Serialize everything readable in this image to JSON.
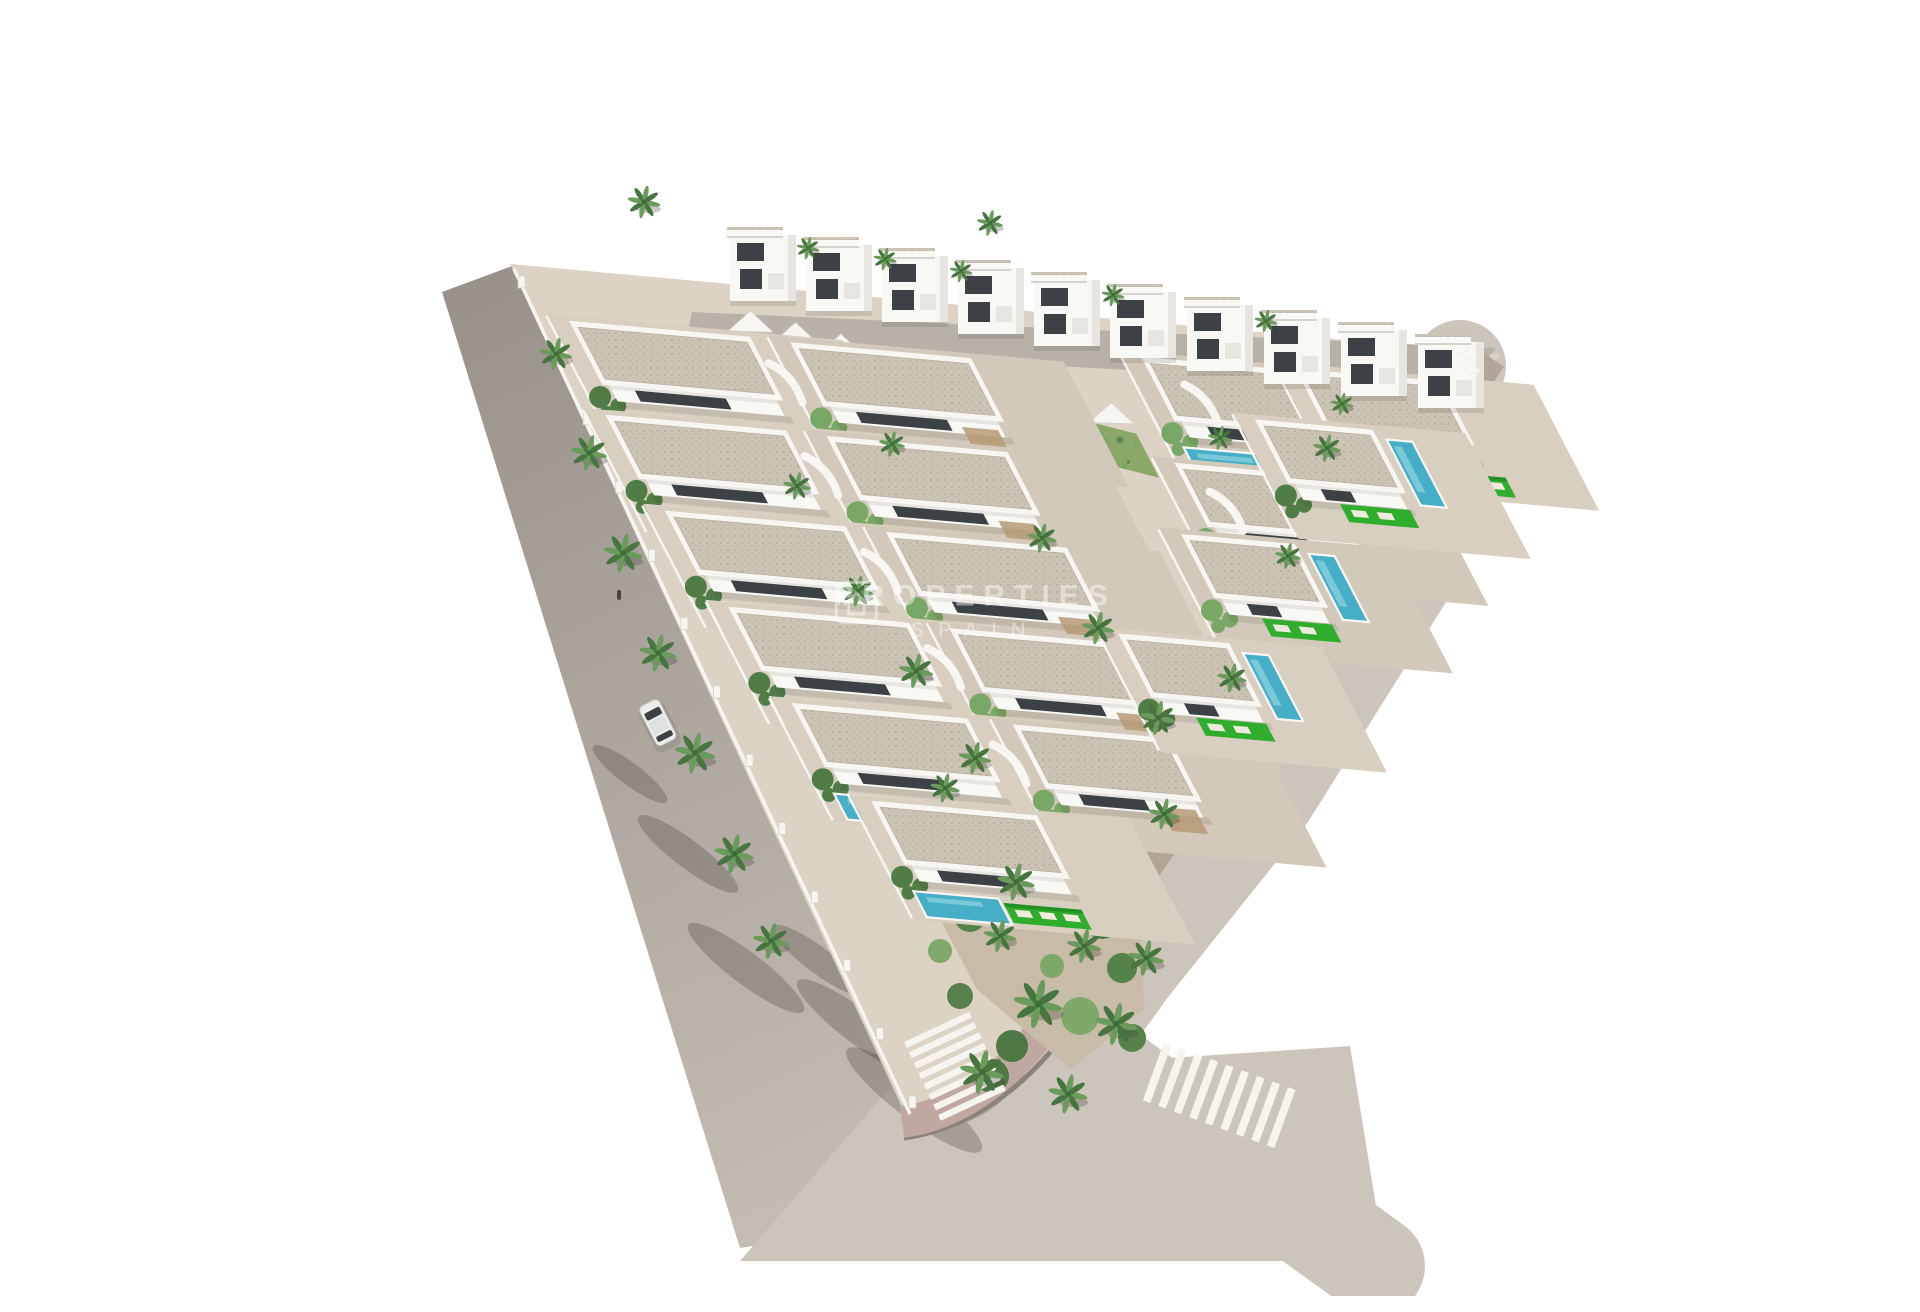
{
  "meta": {
    "type": "architectural-aerial-render",
    "subject": "Aerial 3D render of a triangular residential development of white Ibiza-style villas with private pools, perimeter roads, zebra crossings and a landscaped corner garden"
  },
  "watermark": {
    "line1": "PROPERTIES",
    "line2": "SPAIN",
    "opacity": 0.45
  },
  "palette": {
    "bg": "#ffffff",
    "road_top": "#98928b",
    "road_bottom": "#c6bfb5",
    "road_beige": "#ccc5bc",
    "street": "#b7b1a8",
    "sidewalk": "#b2a497",
    "paver": "#c0a8a0",
    "curbdark": "#8a837c",
    "curb": "#f6f5f1",
    "plot": "#dcd3c4",
    "terrace_a": "#d8cfc0",
    "terrace_b": "#d3c9ba",
    "roof": "#cbc3b3",
    "roof_dot": "#b1a795",
    "roof_dot2": "#bfb6a5",
    "parapet": "#f7f6f2",
    "villa": "#f8f8f5",
    "villa_shade": "#e6e5e0",
    "opening": "#3c4145",
    "pool": "#46aec6",
    "pool_light": "#8fd4df",
    "lawn": "#2fae2e",
    "lawn_dark": "#249126",
    "lounger": "#efeadb",
    "pergola": "#b79a77",
    "bush": "#4f7d45",
    "bush_light": "#79a765",
    "palm1": "#6b9b5c",
    "palm2": "#47753f",
    "slope": "#8aa968",
    "slope_dark": "#5f8b4e",
    "slope_light": "#a8c47f",
    "wall_shade": "#d5d3cb",
    "shadow": "rgba(60,55,47,0.27)",
    "stripe": "#f5f4ef",
    "car": "#ebecec",
    "car_glass": "#3c4146",
    "car_roof": "#dfe1e1",
    "figure": "#4a423c",
    "trunk": "#8a795c"
  },
  "projection": {
    "origin": [
      470,
      250
    ],
    "uy": 0.088,
    "vx": 0.52
  },
  "roads": {
    "left_pts": "402,276 472,250 945,1195 700,1232",
    "bottom_patch": "860,1060 1310,1030 1345,1245 700,1245",
    "right_center": "M 1420,350 L 1368,560 L 1230,780 L 1090,955 Q 1000,1085 905,1148",
    "right_stub": "M 1065,1055 L 1335,1250",
    "plot_path": "M 470,248 L 1460,338 L 962,1066 Q 928,1116 868,1104 Z",
    "sidewalk_path": "M 1454,344 L 972,1056 Q 932,1110 868,1098",
    "paver_path": "M 1040,958 Q 962,1092 862,1106",
    "curb_outer_path": "M 1056,972 Q 976,1106 864,1122",
    "top_street": "652,296 1456,332 1424,372 645,330",
    "left_curb": [
      474,
      253,
      870,
      1098
    ],
    "posts": {
      "x0": 481,
      "y0": 266,
      "x1": 872,
      "y1": 1086,
      "count": 13
    }
  },
  "slope": {
    "grid": [
      [
        195,
        48
      ],
      [
        565,
        118
      ],
      [
        565,
        162
      ],
      [
        195,
        92
      ]
    ],
    "speckles": 52
  },
  "sawtooth": {
    "x0": 688,
    "y0": 311,
    "x1": 1094,
    "y1": 414,
    "teeth": 9,
    "up": 16
  },
  "units": [
    {
      "u": 35,
      "v": 55,
      "w": 175,
      "pool": "below"
    },
    {
      "u": 255,
      "v": 57,
      "w": 175,
      "pool": "below",
      "pergola": true
    },
    {
      "u": 22,
      "v": 150,
      "w": 175,
      "pool": "below"
    },
    {
      "u": 242,
      "v": 152,
      "w": 175,
      "pool": "below",
      "pergola": true
    },
    {
      "u": 32,
      "v": 245,
      "w": 175,
      "pool": "below"
    },
    {
      "u": 252,
      "v": 247,
      "w": 175,
      "pool": "below",
      "pergola": true
    },
    {
      "u": 46,
      "v": 340,
      "w": 175,
      "pool": "below"
    },
    {
      "u": 266,
      "v": 342,
      "w": 170,
      "pool": "below",
      "pergola": true
    },
    {
      "u": 60,
      "v": 435,
      "w": 170,
      "pool": "below"
    },
    {
      "u": 280,
      "v": 437,
      "w": 150,
      "pool": "none",
      "pergola": true
    },
    {
      "u": 90,
      "v": 530,
      "w": 160,
      "pool": "below"
    },
    {
      "u": 615,
      "v": 40,
      "w": 145,
      "pool": "below"
    },
    {
      "u": 770,
      "v": 38,
      "w": 140,
      "pool": "below",
      "pergola": true
    },
    {
      "u": 592,
      "v": 148,
      "w": 150,
      "pool": "below"
    },
    {
      "u": 700,
      "v": 95,
      "w": 112,
      "pool": "right"
    },
    {
      "u": 560,
      "v": 222,
      "w": 108,
      "pool": "right"
    },
    {
      "u": 440,
      "v": 332,
      "w": 105,
      "pool": "right"
    }
  ],
  "ramps": [
    [
      218,
      78
    ],
    [
      205,
      172
    ],
    [
      215,
      267
    ],
    [
      229,
      362
    ],
    [
      245,
      457
    ],
    [
      642,
      62
    ],
    [
      610,
      172
    ]
  ],
  "top_villas": [
    [
      690,
      205
    ],
    [
      766,
      215
    ],
    [
      842,
      226
    ],
    [
      918,
      238
    ],
    [
      994,
      250
    ],
    [
      1070,
      262
    ],
    [
      1147,
      275
    ],
    [
      1224,
      288
    ],
    [
      1301,
      300
    ],
    [
      1378,
      312
    ]
  ],
  "palms": [
    [
      604,
      186,
      1.0
    ],
    [
      768,
      232,
      0.7
    ],
    [
      845,
      243,
      0.7
    ],
    [
      921,
      255,
      0.7
    ],
    [
      950,
      207,
      0.8
    ],
    [
      1073,
      279,
      0.7
    ],
    [
      1226,
      305,
      0.7
    ],
    [
      516,
      338,
      1.0
    ],
    [
      549,
      437,
      1.1
    ],
    [
      583,
      537,
      1.2
    ],
    [
      618,
      637,
      1.15
    ],
    [
      655,
      737,
      1.25
    ],
    [
      694,
      838,
      1.2
    ],
    [
      731,
      925,
      1.1
    ],
    [
      757,
      470,
      0.85
    ],
    [
      818,
      575,
      0.95
    ],
    [
      876,
      655,
      1.05
    ],
    [
      935,
      742,
      1.0
    ],
    [
      852,
      428,
      0.8
    ],
    [
      1002,
      522,
      0.9
    ],
    [
      1058,
      612,
      1.0
    ],
    [
      1118,
      702,
      1.05
    ],
    [
      976,
      866,
      1.15
    ],
    [
      1044,
      930,
      1.05
    ],
    [
      905,
      772,
      0.9
    ],
    [
      1287,
      432,
      0.85
    ],
    [
      1248,
      540,
      0.8
    ],
    [
      1192,
      662,
      0.9
    ],
    [
      1124,
      798,
      0.95
    ],
    [
      1180,
      422,
      0.75
    ],
    [
      1302,
      388,
      0.7
    ],
    [
      998,
      988,
      1.5
    ],
    [
      1076,
      1008,
      1.3
    ],
    [
      942,
      1056,
      1.35
    ],
    [
      1028,
      1078,
      1.2
    ],
    [
      1106,
      942,
      1.1
    ],
    [
      960,
      920,
      1.0
    ]
  ],
  "garden": {
    "grid": [
      [
        95,
        600
      ],
      [
        240,
        585
      ],
      [
        300,
        635
      ],
      [
        260,
        720
      ],
      [
        150,
        790
      ],
      [
        95,
        715
      ]
    ],
    "pool": [
      105,
      608,
      88,
      26
    ],
    "lawn": [
      105,
      584,
      92,
      20
    ],
    "bushes": [
      [
        930,
        900,
        16
      ],
      [
        1000,
        880,
        14
      ],
      [
        1062,
        905,
        18
      ],
      [
        1082,
        952,
        15
      ],
      [
        1040,
        1000,
        19
      ],
      [
        972,
        1030,
        16
      ],
      [
        920,
        980,
        13
      ],
      [
        1012,
        950,
        12
      ],
      [
        952,
        1060,
        17
      ],
      [
        1092,
        1022,
        14
      ],
      [
        900,
        935,
        12
      ]
    ]
  },
  "road_shadows": [
    [
      648,
      838,
      62,
      14
    ],
    [
      706,
      952,
      72,
      16
    ],
    [
      590,
      758,
      46,
      11
    ],
    [
      820,
      1012,
      78,
      17
    ],
    [
      874,
      1084,
      84,
      19
    ],
    [
      778,
      944,
      56,
      13
    ]
  ],
  "crosswalks": {
    "left": {
      "x": 864,
      "y": 1026,
      "rot": -25,
      "n": 8,
      "sw": 72,
      "sh": 6.5,
      "gap": 11.5,
      "dir": "v"
    },
    "right": {
      "x": 1124,
      "y": 1026,
      "rot": 20,
      "n": 9,
      "sw": 8,
      "sh": 62,
      "gap": 16.5,
      "dir": "h"
    },
    "corner": {
      "x": 1428,
      "y": 332,
      "rot": 63,
      "n": 4,
      "sw": 4,
      "sh": 15,
      "gap": 7.5,
      "dir": "h"
    }
  },
  "car": {
    "x": 598,
    "y": 692,
    "rot": -27,
    "w": 22,
    "h": 44
  },
  "figures": [
    [
      579,
      579
    ],
    [
      612,
      634
    ]
  ]
}
